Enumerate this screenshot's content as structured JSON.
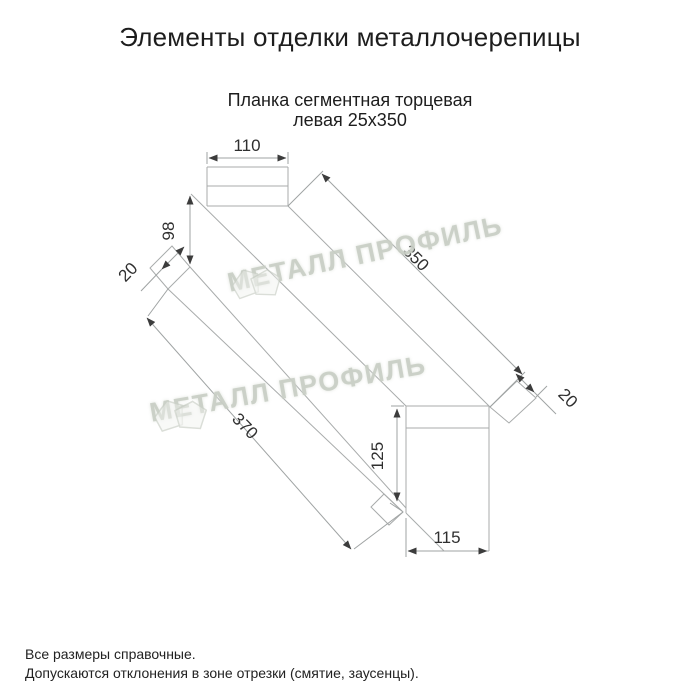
{
  "header": {
    "title": "Элементы отделки металлочерепицы"
  },
  "product": {
    "name_line1": "Планка сегментная торцевая",
    "name_line2": "левая 25х350"
  },
  "drawing": {
    "type": "technical-drawing-oblique",
    "dims": {
      "top_width": "110",
      "left_height": "98",
      "top_flap": "20",
      "edge_right_length": "350",
      "bottom_flap": "20",
      "edge_left_length": "370",
      "bottom_height": "125",
      "bottom_width": "115"
    }
  },
  "watermark": {
    "text": "МЕТАЛЛ ПРОФИЛЬ"
  },
  "footer": {
    "note1": "Все размеры справочные.",
    "note2": "Допускаются отклонения в зоне отрезки (смятие, заусенцы)."
  },
  "colors": {
    "drawing_line": "#a8abab",
    "dimension_label": "#2f2f2f",
    "watermark": "#c5cbc2",
    "text": "#1d1d1d"
  }
}
